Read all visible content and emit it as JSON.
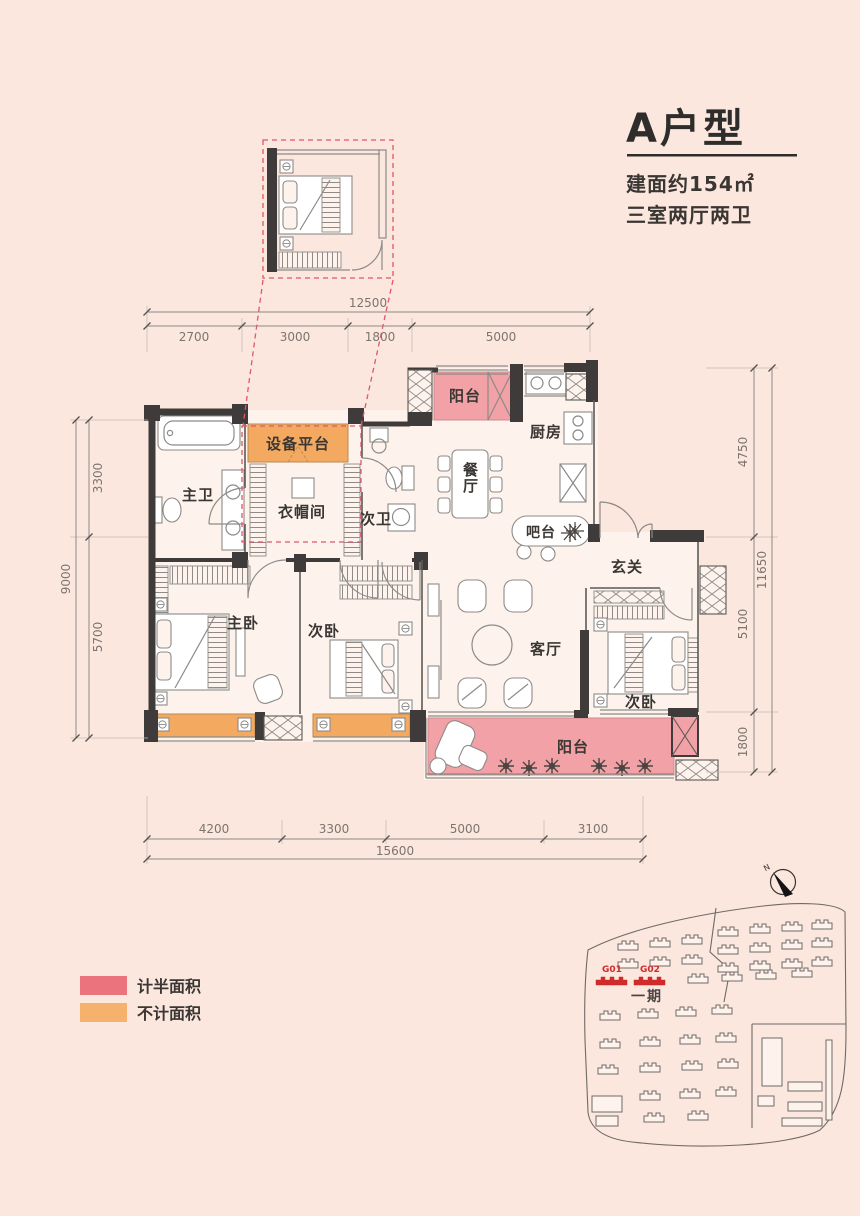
{
  "title": {
    "name": "A户型",
    "area": "建面约154㎡",
    "layout": "三室两厅两卫"
  },
  "rooms": {
    "balcony_top": "阳台",
    "kitchen": "厨房",
    "dining": "餐厅",
    "master_bath": "主卫",
    "equipment_platform": "设备平台",
    "cloakroom": "衣帽间",
    "second_bath": "次卫",
    "bar": "吧台",
    "foyer": "玄关",
    "master_bedroom": "主卧",
    "bedroom_2": "次卧",
    "living_room": "客厅",
    "bedroom_3": "次卧",
    "balcony_bottom": "阳台"
  },
  "dimensions": {
    "top": {
      "total": "12500",
      "segments": [
        "2700",
        "3000",
        "1800",
        "5000"
      ]
    },
    "bottom": {
      "total": "15600",
      "segments": [
        "4200",
        "3300",
        "5000",
        "3100"
      ]
    },
    "left": {
      "total": "9000",
      "segments": [
        "3300",
        "5700"
      ]
    },
    "right": {
      "total": "11650",
      "segments": [
        "4750",
        "5100",
        "1800"
      ]
    }
  },
  "legend": {
    "items": [
      {
        "label": "计半面积",
        "color": "#ea737e"
      },
      {
        "label": "不计面积",
        "color": "#f5b26c"
      }
    ]
  },
  "site_plan": {
    "phase_label": "一期",
    "unit_labels": [
      "G01",
      "G02"
    ],
    "compass_label": "N"
  },
  "colors": {
    "background": "#fce7de",
    "plan_floor": "#fdf3ec",
    "half_area_fill": "#f2a2a6",
    "excluded_area_fill": "#f3aa60",
    "wall": "#3e3b3a",
    "dashed_red": "#e0566a",
    "site_red": "#cf2b2b"
  }
}
